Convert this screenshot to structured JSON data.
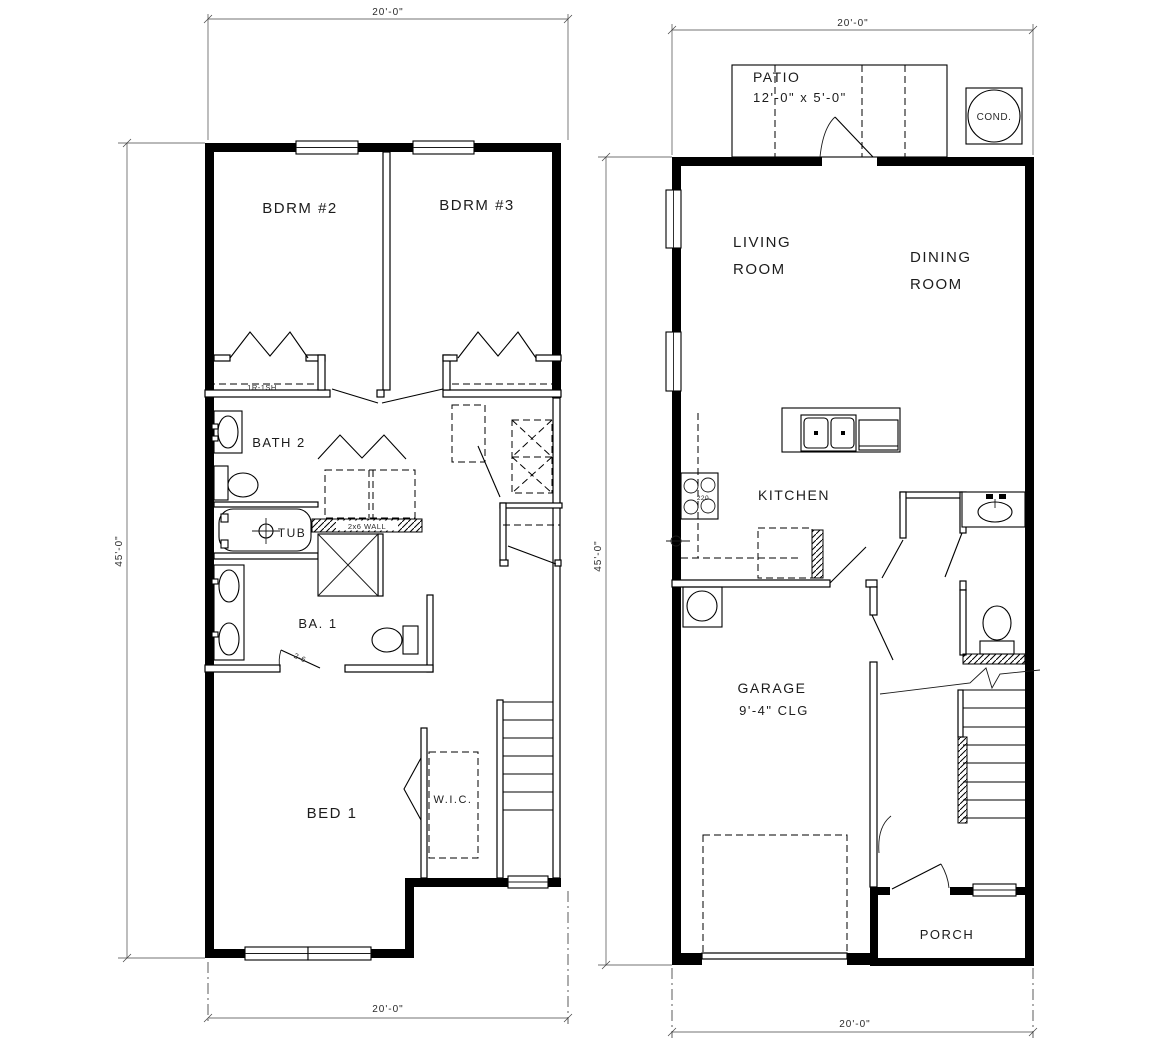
{
  "drawing": {
    "background": "#ffffff",
    "line_color": "#000000",
    "left_plan": {
      "dim_top": "20'-0\"",
      "dim_left": "45'-0\"",
      "dim_bottom": "20'-0\"",
      "labels": {
        "bdrm2": "BDRM #2",
        "bdrm3": "BDRM #3",
        "closet_note": "1R-1SH",
        "bath2": "BATH 2",
        "tub": "TUB",
        "wall_note": "2x6 WALL",
        "ba1": "BA. 1",
        "door_size": "2-6",
        "bed1": "BED 1",
        "wic": "W.I.C."
      }
    },
    "right_plan": {
      "dim_top": "20'-0\"",
      "dim_left": "45'-0\"",
      "dim_bottom": "20'-0\"",
      "labels": {
        "patio": "PATIO",
        "patio_size": "12'-0\" x 5'-0\"",
        "cond": "COND.",
        "living_line1": "LIVING",
        "living_line2": "ROOM",
        "dining_line1": "DINING",
        "dining_line2": "ROOM",
        "kitchen": "KITCHEN",
        "range_note": "220",
        "garage": "GARAGE",
        "garage_ceiling": "9'-4\" CLG",
        "porch": "PORCH"
      }
    }
  }
}
